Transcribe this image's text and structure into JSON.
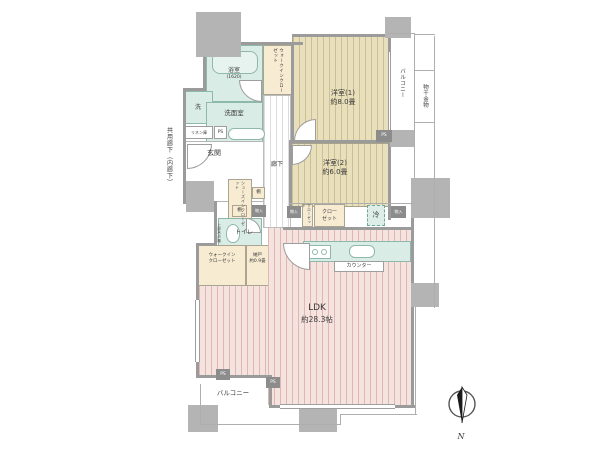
{
  "plan": {
    "rooms": {
      "bath": {
        "name": "浴室",
        "size": "(1620)"
      },
      "laundry": {
        "name": "洗"
      },
      "washroom": {
        "name": "洗面室"
      },
      "linen": {
        "name": "リネン庫"
      },
      "genkan": {
        "name": "玄関"
      },
      "hallway": {
        "name": "廊下"
      },
      "wic_top": {
        "name": "ウォークインクローゼット"
      },
      "bedroom1": {
        "name": "洋室(1)",
        "area": "約8.0畳"
      },
      "bedroom2": {
        "name": "洋室(2)",
        "area": "約6.0畳"
      },
      "shoes_closet": {
        "name": "シューズインクローゼット"
      },
      "toilet": {
        "name": "トイレ",
        "upper_shelf": "上部吊戸棚"
      },
      "wic_bottom": {
        "line1": "ウォークイン",
        "line2": "クローゼット"
      },
      "nando": {
        "name": "納戸",
        "area": "約0.9畳"
      },
      "closet": {
        "name": "クローゼット",
        "line1": "クロー",
        "line2": "ゼット"
      },
      "fridge": {
        "name": "冷"
      },
      "counter": {
        "name": "カウンター"
      },
      "ldk": {
        "name": "LDK",
        "area": "約28.3帖"
      },
      "balcony": {
        "name": "バルコニー"
      },
      "hanger": {
        "name": "物干金物"
      },
      "corridor": {
        "name": "共用廊下（内廊下）"
      }
    },
    "tags": {
      "ps": "PS",
      "shelf": "棚",
      "storage": "物入"
    },
    "compass": {
      "north": "N"
    },
    "colors": {
      "wall": "#9b9b9b",
      "pillar": "#b4b4b4",
      "wet_area_fill": "#d9ece5",
      "wet_area_border": "#8fb8ac",
      "closet_fill": "#f7ecd2",
      "bedroom_fill": "#e8dfbc",
      "bedroom_stripe": "#cdbf8e",
      "ldk_fill": "#f5e3df",
      "ldk_stripe": "#dfb6b0",
      "dark_tag": "#8c8c8c"
    }
  }
}
